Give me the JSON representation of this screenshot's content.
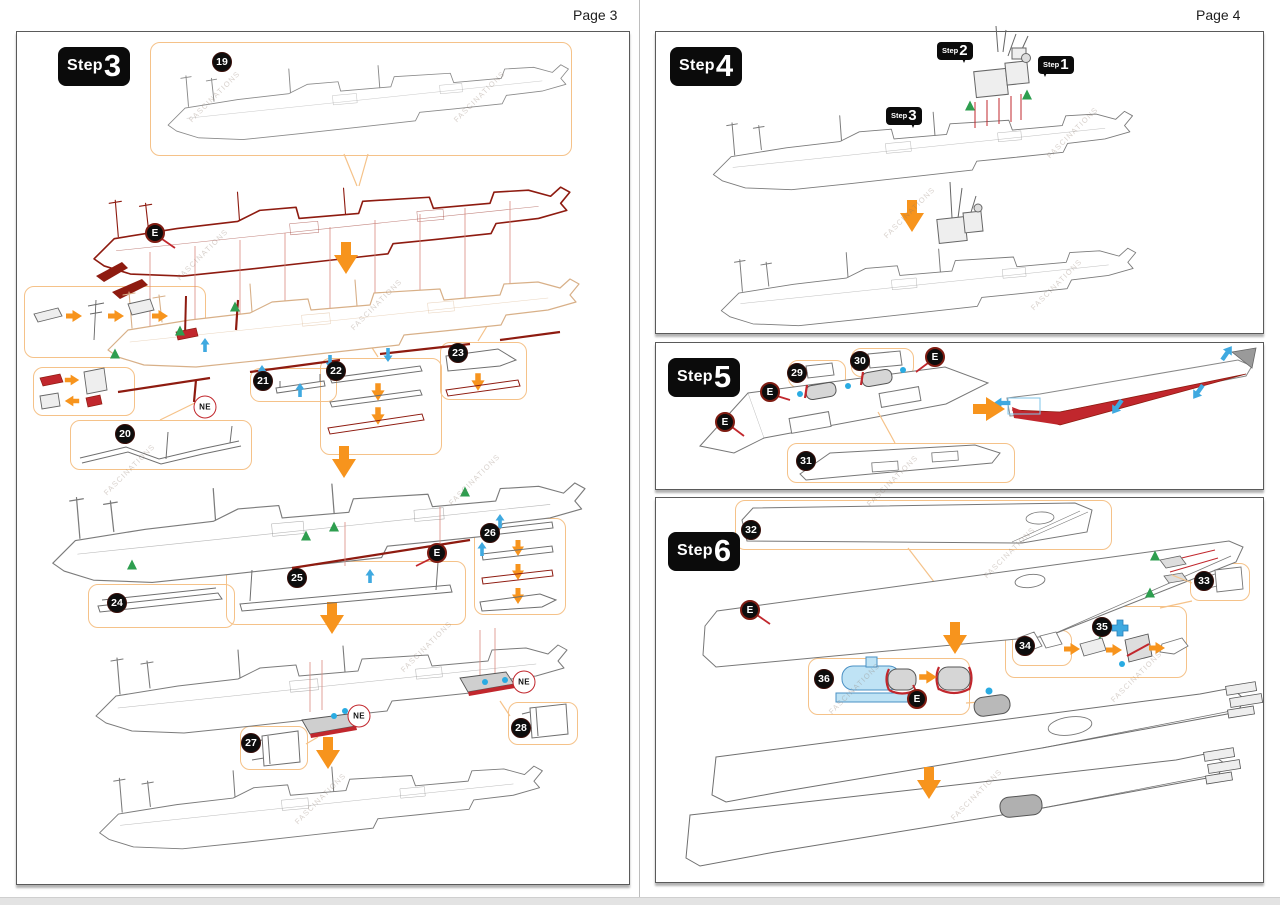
{
  "document": {
    "left_page_header": "Page 3",
    "right_page_header": "Page 4",
    "watermark": "FASCINATIONS"
  },
  "labels": {
    "step_prefix": "Step",
    "e_marker": "E",
    "ne_marker": "NE"
  },
  "steps": {
    "step3": "3",
    "step4": "4",
    "step5": "5",
    "step6": "6",
    "sub_step1": "1",
    "sub_step2": "2",
    "sub_step3": "3"
  },
  "left_parts": [
    "19",
    "20",
    "21",
    "22",
    "23",
    "24",
    "25",
    "26",
    "27",
    "28"
  ],
  "right_parts": [
    "29",
    "30",
    "31",
    "32",
    "33",
    "34",
    "35",
    "36"
  ],
  "colors": {
    "arrow_orange": "#F7941D",
    "callout_border": "#F5C289",
    "deck_red": "#8E1B10",
    "bright_red": "#C1272D",
    "tan_outline": "#D8B088",
    "marker_blue": "#29ABE2",
    "arrow_blue": "#3FA9E0",
    "marker_green": "#2E9E4F",
    "part_light_blue": "#BFE3F5",
    "line_gray": "#6F6F6F",
    "badge_black": "#0D0D0D"
  }
}
